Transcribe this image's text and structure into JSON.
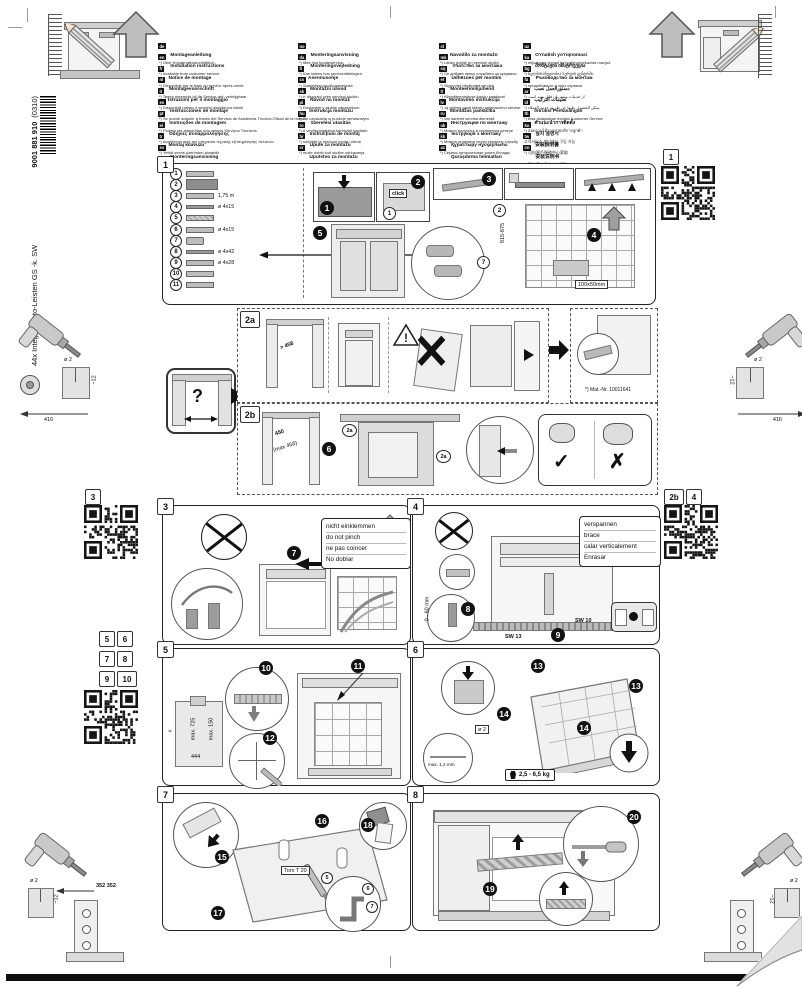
{
  "page": {
    "spine_title": "44x Integr- Kusto-Leisten GS -k. SW",
    "spine_number": "9001 881 910",
    "spine_revision": "(0310)"
  },
  "languages": {
    "col1": [
      {
        "code": "de",
        "title": "Montageanleitung",
        "note": "*) Über Kundendienst erhältlich"
      },
      {
        "code": "en",
        "title": "Installation instructions",
        "note": "*) Available from customer service"
      },
      {
        "code": "fr",
        "title": "Notice de montage",
        "note": "*) Disponible par le biais du service après-vente"
      },
      {
        "code": "nl",
        "title": "Montagevoorschrift",
        "note": "*) Tegen meerprijs bij de Service-afd. verkrijgbaar"
      },
      {
        "code": "it",
        "title": "Istruzioni per il montaggio",
        "note": "*) Disponibili presso il servizio assistenza clienti"
      },
      {
        "code": "es",
        "title": "Instrucciones de montaje",
        "note": "*) Se puede adquirir a través del Servicio de Asistencia Técnica Oficial de la marca"
      },
      {
        "code": "pt",
        "title": "Instruções de montagem",
        "note": "*) Podem ser adquiridas nos nossos Serviços Técnicos"
      },
      {
        "code": "el",
        "title": "Οδηγίες συναρμολόγησης",
        "note": "*) Διατίθενται από την υπηρεσία τεχνικής εξυπηρέτησης πελατών"
      },
      {
        "code": "tr",
        "title": "Montaj kılavuzu",
        "note": "*) Yetkili servis üzerinden alınabilir"
      },
      {
        "code": "sv",
        "title": "Monteringsanvisning",
        "note": "*) Kan fås via Service"
      }
    ],
    "col2": [
      {
        "code": "no",
        "title": "Monteringsanvisning",
        "note": "*) fåes hos kundeservice"
      },
      {
        "code": "da",
        "title": "Monteringsvejledning",
        "note": "*) Kan købes hos serviceafdelingen"
      },
      {
        "code": "fi",
        "title": "Asennusohje",
        "note": "*) Saatavissa huoltopalvelusta"
      },
      {
        "code": "cs",
        "title": "Montážní návod",
        "note": "*) K dispozici přes servisní službu"
      },
      {
        "code": "sk",
        "title": "Návod na montáž",
        "note": "*) Dostanete v službe zákazníkom"
      },
      {
        "code": "pl",
        "title": "Instrukcja montażu",
        "note": "*) Do uzyskania w punkcie serwisowym"
      },
      {
        "code": "hu",
        "title": "Szerelési utasítás",
        "note": "*) A vevőszolgálaton keresztül kapható"
      },
      {
        "code": "ro",
        "title": "Instrucțiuni de montaj",
        "note": "*) solicitați la serviciul pentru clienți"
      },
      {
        "code": "hr",
        "title": "Upute za montažu",
        "note": "*) može dobiti kod službe održavanja"
      },
      {
        "code": "sr",
        "title": "Uputstvo za montažu",
        "note": "*) Može se nabaviti preko servisne službe"
      }
    ],
    "col3": [
      {
        "code": "sl",
        "title": "Navodilo za montažo",
        "note": "*) Lahko dobite pri servisni službi"
      },
      {
        "code": "mk",
        "title": "Упатство за монтажа",
        "note": "*) Се добива преку службата за купувачи"
      },
      {
        "code": "sq",
        "title": "Udhëzues për montim",
        "note": "*) Sigurohet nëpërmjet servisit"
      },
      {
        "code": "et",
        "title": "Monteerimisjuhend",
        "note": "*) Klienditeeninduse kaudu saadaval"
      },
      {
        "code": "lt",
        "title": "Montavimo instrukcija",
        "note": "*) Ją galima gauti klientų aptarnavimo servise"
      },
      {
        "code": "lv",
        "title": "Montāžas pamācība",
        "note": "*) Var saņemt servisa dienestā"
      },
      {
        "code": "ru",
        "title": "Инструкция по монтажу",
        "note": "*) Можно получить в сервисном центре"
      },
      {
        "code": "uk",
        "title": "Інструкція з монтажу",
        "note": "*) Можна отримати через сервісну службу"
      },
      {
        "code": "kk",
        "title": "Құрастыру нұсқаулығы",
        "note": "*) Сервис орталығынан алуға болады"
      },
      {
        "code": "az",
        "title": "Quraşdırma təlimatları",
        "note": "*) Müştəri xidmətlərindən əldə oluna bilər"
      }
    ],
    "col4": [
      {
        "code": "uz",
        "title": "O'rnatish yo'riqnomasi",
        "note": "*) mijozlarga xizmat ko'rsatish markazida mavjud"
      },
      {
        "code": "ka",
        "title": "მონტაჟის ინსტრუქცია",
        "note": "*) ხელმისაწვდომია სერვის ცენტრში"
      },
      {
        "code": "bg",
        "title": "Ръководство за монтаж",
        "note": "*) придобива се и чрез сервиза"
      },
      {
        "code": "fa",
        "title": "دستورالعمل نصب",
        "note": "*) از خدمات مشتریان قابل تهیه است"
      },
      {
        "code": "ar",
        "title": "تعليمات التركيب",
        "note": "*) يمكن الحصول عليها عن طريق خدمة العملاء"
      },
      {
        "code": "id",
        "title": "Intruksi Pemasangan",
        "note": "*) bisa didapatkan melalui Customer Service"
      },
      {
        "code": "th",
        "title": "คำแนะนำการติดตั้ง",
        "note": "*) สอบถามได้จากฝ่ายบริการลูกค้า"
      },
      {
        "code": "ko",
        "title": "설치 설명서",
        "note": "고객서비스 센터에서 구입 가능"
      },
      {
        "code": "tw",
        "title": "安裝說明書",
        "note": "*) 可向客戶服務中心索取"
      },
      {
        "code": "cn",
        "title": "安装说明书",
        "note": "*) 可向客户服务中心索取"
      }
    ]
  },
  "section1": {
    "label": "1",
    "qr_label": "1",
    "parts": [
      {
        "num": "1",
        "label": "",
        "glyph": "strip"
      },
      {
        "num": "2",
        "label": "",
        "glyph": "panel"
      },
      {
        "num": "3",
        "label": "1,75 m",
        "glyph": "grommets"
      },
      {
        "num": "4",
        "label": "ø 4x15",
        "glyph": "screws"
      },
      {
        "num": "5",
        "label": "",
        "glyph": "wedges"
      },
      {
        "num": "6",
        "label": "ø 4x15",
        "glyph": "brackets"
      },
      {
        "num": "7",
        "label": "",
        "glyph": "clips"
      },
      {
        "num": "8",
        "label": "ø 4x42",
        "glyph": "screw"
      },
      {
        "num": "9",
        "label": "ø 4x28",
        "glyph": "washers"
      },
      {
        "num": "10",
        "label": "",
        "glyph": "angles"
      },
      {
        "num": "11",
        "label": "",
        "glyph": "cap"
      }
    ],
    "steps": [
      "1",
      "2",
      "3",
      "4",
      "5"
    ],
    "click": "click",
    "niche_height": "815-875",
    "plate_size": "100x50mm",
    "ref2": "2",
    "ref7": "7",
    "ref1": "1"
  },
  "section2a": {
    "label": "2a",
    "niche_width": "> 458",
    "mat_nr": "*) Mat.-Nr. 10011641"
  },
  "question_box": {
    "mark": "?"
  },
  "section2b": {
    "label": "2b",
    "step": "6",
    "width": "450",
    "width_max": "(max 458)",
    "ref": "2a",
    "check": "✓",
    "cross": "✗"
  },
  "section3": {
    "label": "3",
    "step": "7",
    "note_lines": [
      "nicht einklemmen",
      "do not pinch",
      "ne pas coincer",
      "No doblar"
    ]
  },
  "section4": {
    "label": "4",
    "steps": [
      "8",
      "9"
    ],
    "note_lines": [
      "verspannen",
      "brace",
      "calar verticalement",
      "Enrasar"
    ],
    "adjust_range": "0 - 60 mm",
    "wrench_small": "SW 10",
    "wrench_large": "SW 13"
  },
  "section5": {
    "label": "5",
    "steps": [
      "10",
      "11",
      "12"
    ],
    "dim_x": "x",
    "dim_h": "max. 725",
    "dim_top": "max. 150",
    "dim_w": "444"
  },
  "section6": {
    "label": "6",
    "steps": [
      "13",
      "14"
    ],
    "hole_dia": "ø 2",
    "hole_depth": "~12",
    "gap": "max. 1,2 mm",
    "door_weight": "2,5 - 6,5 kg"
  },
  "section7": {
    "label": "7",
    "steps": [
      "15",
      "16",
      "17",
      "18"
    ],
    "tool": "Torx T 20",
    "part_refs": [
      "5",
      "6",
      "7"
    ]
  },
  "section8": {
    "label": "8",
    "steps": [
      "19",
      "20"
    ]
  },
  "margins": {
    "left_top": {
      "hole_dia": "ø 2",
      "hole_depth": "~12",
      "dim": "416"
    },
    "right_top": {
      "hole_dia": "ø 2",
      "hole_depth": "~12",
      "dim": "416"
    },
    "bottom_left": {
      "hole_dia": "ø 2",
      "hole_depth": "~12",
      "dim": "352 352"
    },
    "bottom_right": {
      "hole_dia": "ø 2",
      "hole_depth": "~12"
    }
  },
  "qr_panels": {
    "top_right_label": "1",
    "left_label": "3",
    "right_labels": [
      "2b",
      "4"
    ],
    "left2_labels": [
      "5",
      "6",
      "7",
      "8",
      "9",
      "10"
    ]
  }
}
